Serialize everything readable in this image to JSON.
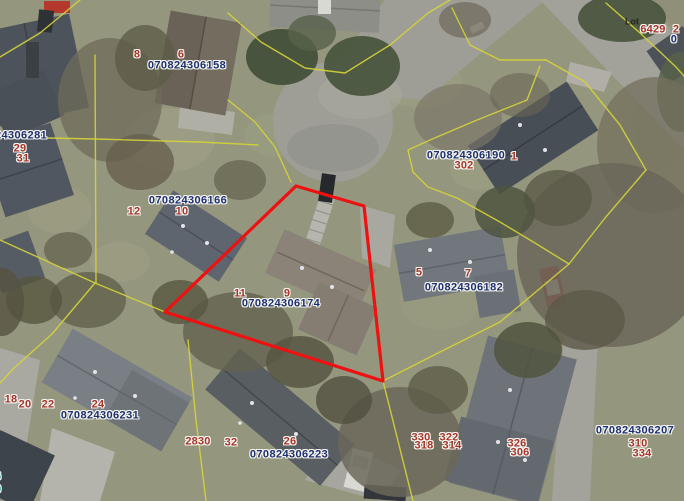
{
  "map": {
    "width": 684,
    "height": 501,
    "colors": {
      "parcel_id_text": "#1d2f6f",
      "house_number_text": "#a5352a",
      "lot_text": "#2a241d",
      "teal_text": "#2ba0a0",
      "boundary_line": "#d4d438",
      "highlight_outline": "#ee1111"
    },
    "highlighted_parcel": {
      "parcel_id": "070824306174",
      "points": "296,186 364,206 383,381 165,312"
    },
    "parcel_boundaries": [
      "80,0 40,33 0,57",
      "228,13 261,42 305,68 345,73 390,45 428,13 450,0",
      "228,100 255,122 275,147 291,182",
      "95,55 96,283",
      "0,137 96,139 200,142 258,145",
      "0,240 95,283",
      "95,283 165,312",
      "95,283 52,334 14,368 0,383",
      "188,340 196,420 206,501",
      "165,312 383,381",
      "383,381 413,501",
      "383,381 440,352 500,322 569,264",
      "569,264 605,218 646,170",
      "452,8 470,45 500,60 546,60",
      "546,60 585,82 620,125 646,170",
      "606,3 640,33 676,67 684,76",
      "540,66 527,100 477,120 430,140 408,150 413,172 428,187 457,198 500,222 535,243 569,264"
    ],
    "labels": {
      "parcel_ids": [
        {
          "text": "070824306158",
          "x": 187,
          "y": 66
        },
        {
          "text": "070824306281",
          "x": 8,
          "y": 136
        },
        {
          "text": "070824306190",
          "x": 466,
          "y": 156
        },
        {
          "text": "070824306166",
          "x": 188,
          "y": 201
        },
        {
          "text": "070824306174",
          "x": 281,
          "y": 304
        },
        {
          "text": "070824306182",
          "x": 464,
          "y": 288
        },
        {
          "text": "070824306231",
          "x": 100,
          "y": 416
        },
        {
          "text": "070824306223",
          "x": 289,
          "y": 455
        },
        {
          "text": "070824306207",
          "x": 635,
          "y": 431
        },
        {
          "text": "0",
          "x": 674,
          "y": 40
        }
      ],
      "house_numbers": [
        {
          "text": "8",
          "x": 137,
          "y": 55
        },
        {
          "text": "6",
          "x": 181,
          "y": 55
        },
        {
          "text": "29",
          "x": 20,
          "y": 149
        },
        {
          "text": "31",
          "x": 23,
          "y": 159
        },
        {
          "text": "1",
          "x": 514,
          "y": 157
        },
        {
          "text": "302",
          "x": 464,
          "y": 166
        },
        {
          "text": "6429",
          "x": 653,
          "y": 30
        },
        {
          "text": "2",
          "x": 676,
          "y": 30
        },
        {
          "text": "12",
          "x": 134,
          "y": 212
        },
        {
          "text": "10",
          "x": 182,
          "y": 212
        },
        {
          "text": "11",
          "x": 240,
          "y": 294
        },
        {
          "text": "9",
          "x": 287,
          "y": 294
        },
        {
          "text": "5",
          "x": 419,
          "y": 273
        },
        {
          "text": "7",
          "x": 468,
          "y": 274
        },
        {
          "text": "18",
          "x": 11,
          "y": 400
        },
        {
          "text": "20",
          "x": 25,
          "y": 405
        },
        {
          "text": "22",
          "x": 48,
          "y": 405
        },
        {
          "text": "24",
          "x": 98,
          "y": 405
        },
        {
          "text": "2830",
          "x": 198,
          "y": 442
        },
        {
          "text": "32",
          "x": 231,
          "y": 443
        },
        {
          "text": "26",
          "x": 290,
          "y": 442
        },
        {
          "text": "330",
          "x": 421,
          "y": 438
        },
        {
          "text": "322",
          "x": 449,
          "y": 438
        },
        {
          "text": "318",
          "x": 424,
          "y": 446
        },
        {
          "text": "314",
          "x": 452,
          "y": 446
        },
        {
          "text": "326",
          "x": 517,
          "y": 444
        },
        {
          "text": "306",
          "x": 520,
          "y": 453
        },
        {
          "text": "310",
          "x": 638,
          "y": 444
        },
        {
          "text": "334",
          "x": 642,
          "y": 454
        }
      ],
      "other": [
        {
          "text": "Lot",
          "x": 632,
          "y": 22,
          "type": "lot"
        },
        {
          "text": "6",
          "x": -2,
          "y": 477,
          "type": "teal"
        },
        {
          "text": "9",
          "x": -2,
          "y": 490,
          "type": "teal"
        }
      ]
    }
  }
}
